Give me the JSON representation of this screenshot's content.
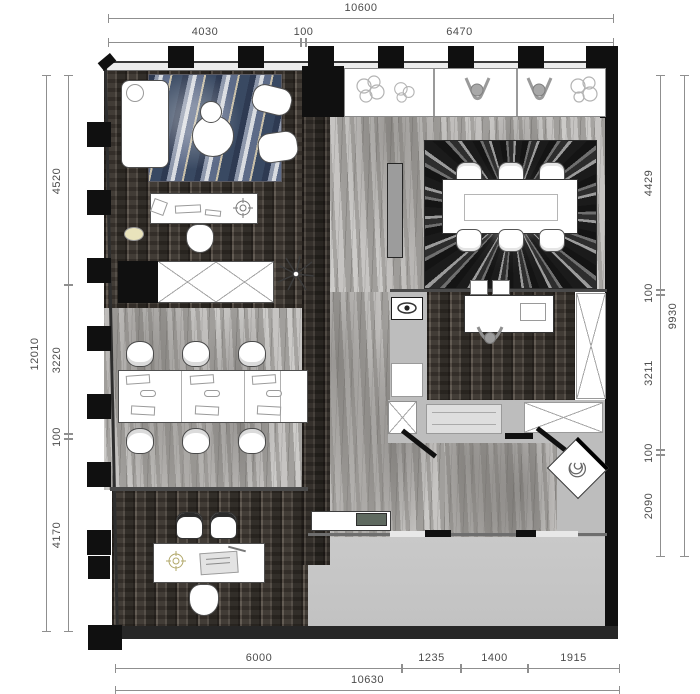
{
  "drawing": {
    "kind": "office floor plan",
    "dimensions": {
      "top": {
        "overall": "10600",
        "segments": [
          "4030",
          "100",
          "6470"
        ]
      },
      "left": {
        "overall": "12010",
        "segments": [
          "4520",
          "3220",
          "100",
          "4170"
        ]
      },
      "right": {
        "overall": "9930",
        "segments": [
          "4429",
          "100",
          "3211",
          "100",
          "2090"
        ]
      },
      "bottom": {
        "overall": "10630",
        "segments": [
          "6000",
          "1235",
          "1400",
          "1915"
        ]
      }
    },
    "palette": {
      "wall_black": "#101010",
      "wood_floor": "#46403a",
      "marble_floor": "#b6b4b1",
      "lobby_gray": "#c6c6c6",
      "rug_agate_blue": "#46536e",
      "rug_burst_dark": "#262626",
      "dim_line": "#8f8f8f",
      "dim_text": "#4c4c4c",
      "reception_screen": "#5f6a60",
      "lamp_yellow": "#e9e3bc"
    },
    "icons": {
      "palm-plant-icon": "radiating fronds",
      "plant-icon": "leafy cluster outline",
      "person-figure-icon": "top view seated person",
      "ceiling-light-icon": "crosshair target",
      "lamp-icon": "eye-shaped sconce",
      "spiral-chair-icon": "swivel lounge chair"
    }
  }
}
